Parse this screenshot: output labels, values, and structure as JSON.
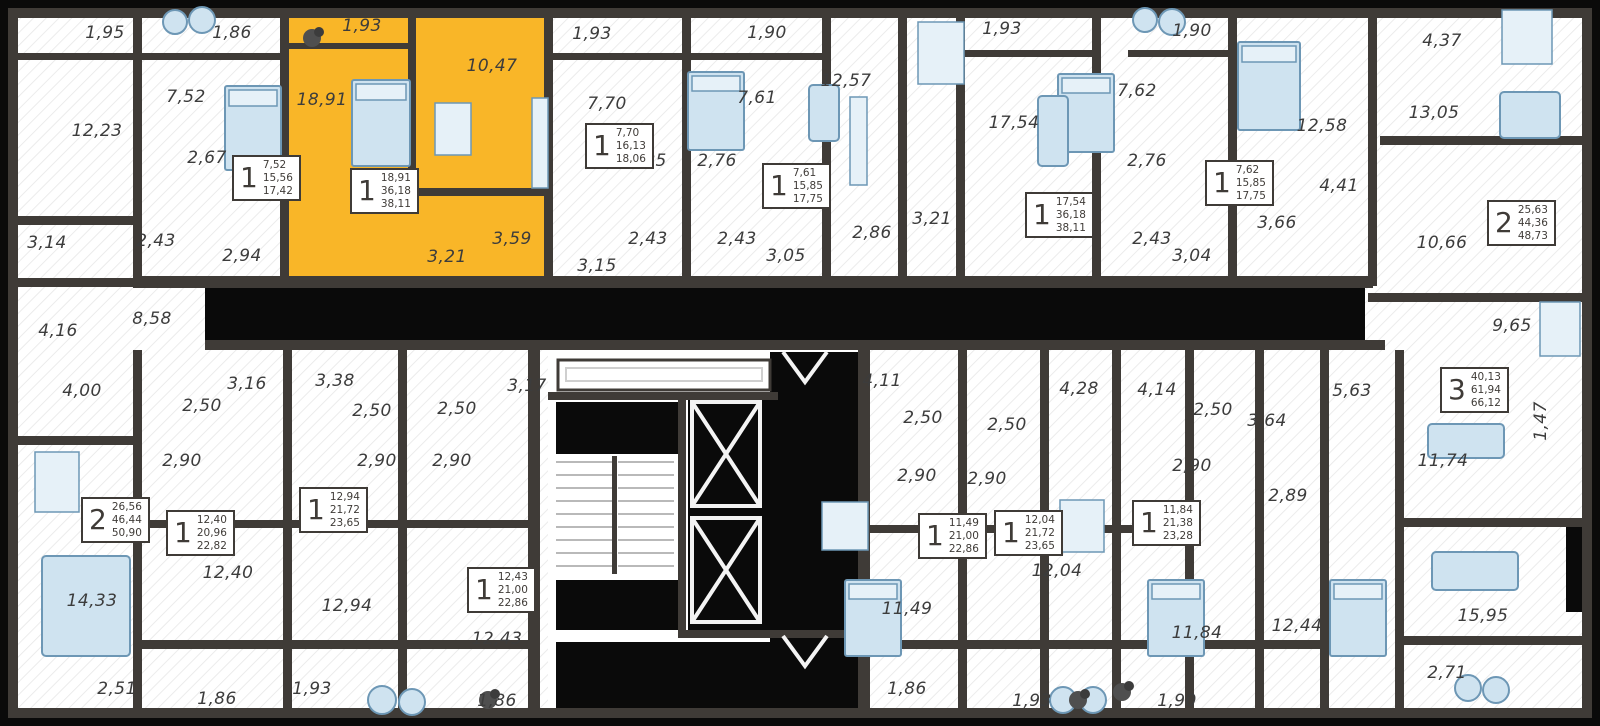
{
  "colors": {
    "background": "#060606",
    "wall": "#3f3b37",
    "void_fill": "#0a0a0a",
    "floor": "#ffffff",
    "hatch": "#e7e7e7",
    "highlight": "#f9b628",
    "furniture_fill": "#cfe3f0",
    "furniture_stroke": "#6d97b5",
    "label_text": "#3c3c3c"
  },
  "selected_apartment": {
    "rooms": "1",
    "areas": [
      "18,91",
      "36,18",
      "38,11"
    ],
    "room_areas": [
      "1,93",
      "18,91",
      "10,47",
      "3,21",
      "3,59"
    ]
  },
  "rooms": [
    {
      "label": "1,95",
      "x": 105,
      "y": 33
    },
    {
      "label": "1,86",
      "x": 232,
      "y": 33
    },
    {
      "label": "1,93",
      "x": 362,
      "y": 26
    },
    {
      "label": "10,47",
      "x": 492,
      "y": 66
    },
    {
      "label": "18,91",
      "x": 322,
      "y": 100
    },
    {
      "label": "7,52",
      "x": 186,
      "y": 97
    },
    {
      "label": "12,23",
      "x": 97,
      "y": 131
    },
    {
      "label": "2,67",
      "x": 207,
      "y": 158
    },
    {
      "label": "3,14",
      "x": 47,
      "y": 243
    },
    {
      "label": "2,43",
      "x": 156,
      "y": 241
    },
    {
      "label": "2,94",
      "x": 242,
      "y": 256
    },
    {
      "label": "3,21",
      "x": 447,
      "y": 257
    },
    {
      "label": "3,59",
      "x": 512,
      "y": 239
    },
    {
      "label": "1,93",
      "x": 592,
      "y": 34
    },
    {
      "label": "7,70",
      "x": 607,
      "y": 104
    },
    {
      "label": "2,85",
      "x": 647,
      "y": 161
    },
    {
      "label": "2,43",
      "x": 648,
      "y": 239
    },
    {
      "label": "3,15",
      "x": 597,
      "y": 266
    },
    {
      "label": "1,90",
      "x": 767,
      "y": 33
    },
    {
      "label": "7,61",
      "x": 757,
      "y": 98
    },
    {
      "label": "2,76",
      "x": 717,
      "y": 161
    },
    {
      "label": "2,43",
      "x": 737,
      "y": 239
    },
    {
      "label": "3,05",
      "x": 786,
      "y": 256
    },
    {
      "label": "12,57",
      "x": 846,
      "y": 81
    },
    {
      "label": "2,86",
      "x": 872,
      "y": 233
    },
    {
      "label": "3,21",
      "x": 932,
      "y": 219
    },
    {
      "label": "1,93",
      "x": 1002,
      "y": 29
    },
    {
      "label": "17,54",
      "x": 1014,
      "y": 123
    },
    {
      "label": "7,62",
      "x": 1137,
      "y": 91
    },
    {
      "label": "2,76",
      "x": 1147,
      "y": 161
    },
    {
      "label": "2,43",
      "x": 1152,
      "y": 239
    },
    {
      "label": "3,04",
      "x": 1192,
      "y": 256
    },
    {
      "label": "1,90",
      "x": 1192,
      "y": 31
    },
    {
      "label": "12,58",
      "x": 1322,
      "y": 126
    },
    {
      "label": "3,66",
      "x": 1277,
      "y": 223
    },
    {
      "label": "4,41",
      "x": 1339,
      "y": 186
    },
    {
      "label": "4,37",
      "x": 1442,
      "y": 41
    },
    {
      "label": "13,05",
      "x": 1434,
      "y": 113
    },
    {
      "label": "10,66",
      "x": 1442,
      "y": 243
    },
    {
      "label": "4,16",
      "x": 58,
      "y": 331
    },
    {
      "label": "8,58",
      "x": 152,
      "y": 319
    },
    {
      "label": "4,00",
      "x": 82,
      "y": 391
    },
    {
      "label": "3,16",
      "x": 247,
      "y": 384
    },
    {
      "label": "3,38",
      "x": 335,
      "y": 381
    },
    {
      "label": "2,50",
      "x": 202,
      "y": 406
    },
    {
      "label": "2,50",
      "x": 372,
      "y": 411
    },
    {
      "label": "2,50",
      "x": 457,
      "y": 409
    },
    {
      "label": "3,17",
      "x": 527,
      "y": 386
    },
    {
      "label": "2,90",
      "x": 182,
      "y": 461
    },
    {
      "label": "2,90",
      "x": 377,
      "y": 461
    },
    {
      "label": "2,90",
      "x": 452,
      "y": 461
    },
    {
      "label": "4,11",
      "x": 882,
      "y": 381
    },
    {
      "label": "2,50",
      "x": 923,
      "y": 418
    },
    {
      "label": "2,50",
      "x": 1007,
      "y": 425
    },
    {
      "label": "2,90",
      "x": 917,
      "y": 476
    },
    {
      "label": "2,90",
      "x": 987,
      "y": 479
    },
    {
      "label": "4,28",
      "x": 1079,
      "y": 389
    },
    {
      "label": "4,14",
      "x": 1157,
      "y": 390
    },
    {
      "label": "2,50",
      "x": 1213,
      "y": 410
    },
    {
      "label": "2,90",
      "x": 1192,
      "y": 466
    },
    {
      "label": "3,64",
      "x": 1267,
      "y": 421
    },
    {
      "label": "5,63",
      "x": 1352,
      "y": 391
    },
    {
      "label": "9,65",
      "x": 1512,
      "y": 326
    },
    {
      "label": "11,74",
      "x": 1443,
      "y": 461
    },
    {
      "label": "1,47",
      "x": 1541,
      "y": 421,
      "vertical": true
    },
    {
      "label": "2,89",
      "x": 1288,
      "y": 496
    },
    {
      "label": "14,33",
      "x": 92,
      "y": 601
    },
    {
      "label": "2,51",
      "x": 117,
      "y": 689
    },
    {
      "label": "12,40",
      "x": 228,
      "y": 573
    },
    {
      "label": "1,86",
      "x": 217,
      "y": 699
    },
    {
      "label": "12,94",
      "x": 347,
      "y": 606
    },
    {
      "label": "1,93",
      "x": 312,
      "y": 689
    },
    {
      "label": "12,43",
      "x": 497,
      "y": 639
    },
    {
      "label": "1,86",
      "x": 497,
      "y": 701
    },
    {
      "label": "11,49",
      "x": 907,
      "y": 609
    },
    {
      "label": "1,86",
      "x": 907,
      "y": 689
    },
    {
      "label": "12,04",
      "x": 1057,
      "y": 571
    },
    {
      "label": "1,93",
      "x": 1032,
      "y": 701
    },
    {
      "label": "11,84",
      "x": 1197,
      "y": 633
    },
    {
      "label": "1,90",
      "x": 1177,
      "y": 701
    },
    {
      "label": "12,44",
      "x": 1297,
      "y": 626
    },
    {
      "label": "15,95",
      "x": 1483,
      "y": 616
    },
    {
      "label": "2,71",
      "x": 1447,
      "y": 673
    }
  ],
  "stat_boxes": [
    {
      "rooms": "1",
      "areas": [
        "7,52",
        "15,56",
        "17,42"
      ],
      "x": 232,
      "y": 155
    },
    {
      "rooms": "1",
      "areas": [
        "18,91",
        "36,18",
        "38,11"
      ],
      "x": 350,
      "y": 168,
      "selected": true
    },
    {
      "rooms": "1",
      "areas": [
        "7,70",
        "16,13",
        "18,06"
      ],
      "x": 585,
      "y": 123
    },
    {
      "rooms": "1",
      "areas": [
        "7,61",
        "15,85",
        "17,75"
      ],
      "x": 762,
      "y": 163
    },
    {
      "rooms": "1",
      "areas": [
        "17,54",
        "36,18",
        "38,11"
      ],
      "x": 1025,
      "y": 192
    },
    {
      "rooms": "1",
      "areas": [
        "7,62",
        "15,85",
        "17,75"
      ],
      "x": 1205,
      "y": 160
    },
    {
      "rooms": "2",
      "areas": [
        "25,63",
        "44,36",
        "48,73"
      ],
      "x": 1487,
      "y": 200
    },
    {
      "rooms": "2",
      "areas": [
        "26,56",
        "46,44",
        "50,90"
      ],
      "x": 81,
      "y": 497
    },
    {
      "rooms": "1",
      "areas": [
        "12,40",
        "20,96",
        "22,82"
      ],
      "x": 166,
      "y": 510
    },
    {
      "rooms": "1",
      "areas": [
        "12,94",
        "21,72",
        "23,65"
      ],
      "x": 299,
      "y": 487
    },
    {
      "rooms": "1",
      "areas": [
        "12,43",
        "21,00",
        "22,86"
      ],
      "x": 467,
      "y": 567
    },
    {
      "rooms": "1",
      "areas": [
        "11,49",
        "21,00",
        "22,86"
      ],
      "x": 918,
      "y": 513
    },
    {
      "rooms": "1",
      "areas": [
        "12,04",
        "21,72",
        "23,65"
      ],
      "x": 994,
      "y": 510
    },
    {
      "rooms": "1",
      "areas": [
        "11,84",
        "21,38",
        "23,28"
      ],
      "x": 1132,
      "y": 500
    },
    {
      "rooms": "3",
      "areas": [
        "40,13",
        "61,94",
        "66,12"
      ],
      "x": 1440,
      "y": 367
    }
  ]
}
